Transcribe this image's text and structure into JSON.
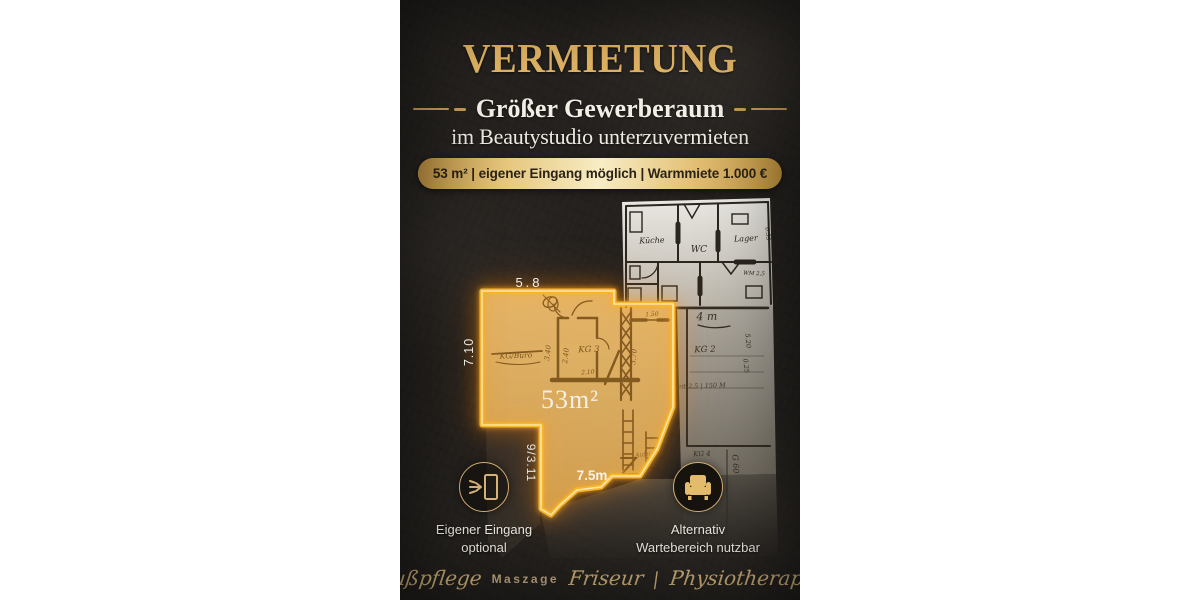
{
  "poster": {
    "title": "VERMIETUNG",
    "subtitle": "Größer Gewerberaum",
    "subtitle2": "im Beautystudio unterzuvermieten",
    "badge": "53 m² | eigener Eingang möglich | Warmmiete 1.000 €",
    "colors": {
      "gold_accent": "#e4b766",
      "outline_glow": "#f8b62d",
      "badge_text": "#2b2315",
      "paper_warm": "#c9b287",
      "background": "#24211e"
    }
  },
  "floorplan": {
    "area": "53m²",
    "dim_top": "5.8",
    "dim_left": "7.10",
    "dim_side": "9/3.11",
    "dim_bottom": "7.5m",
    "sketch": {
      "kueche": "Küche",
      "wc": "WC",
      "lager": "Lager",
      "wm": "WM 2,5",
      "corridor": "4 m",
      "kg2": "KG 2",
      "kg3": "KG 3",
      "kg4": "KG 4",
      "g60": "G 60",
      "kg_buero": "KG/Büro",
      "aufzug": "Aufzug",
      "note": "seit 2,5 | 150 M",
      "d1": "3.40",
      "d2": "2.40",
      "d3": "3.70",
      "d4": "2.10",
      "d5": "1.50",
      "d6": "5.20",
      "d7": "0.25",
      "d8": "0.55"
    }
  },
  "features": [
    {
      "icon": "door-entry-icon",
      "line1": "Eigener Eingang",
      "line2": "optional"
    },
    {
      "icon": "armchair-icon",
      "line1": "Alternativ",
      "line2": "Wartebereich nutzbar"
    }
  ],
  "footer": {
    "items": [
      {
        "text": "Fußpflege"
      },
      {
        "text": "Maszage"
      },
      {
        "text": "Friseur"
      },
      {
        "text": "|"
      },
      {
        "text": "Physiotherapie"
      }
    ]
  }
}
